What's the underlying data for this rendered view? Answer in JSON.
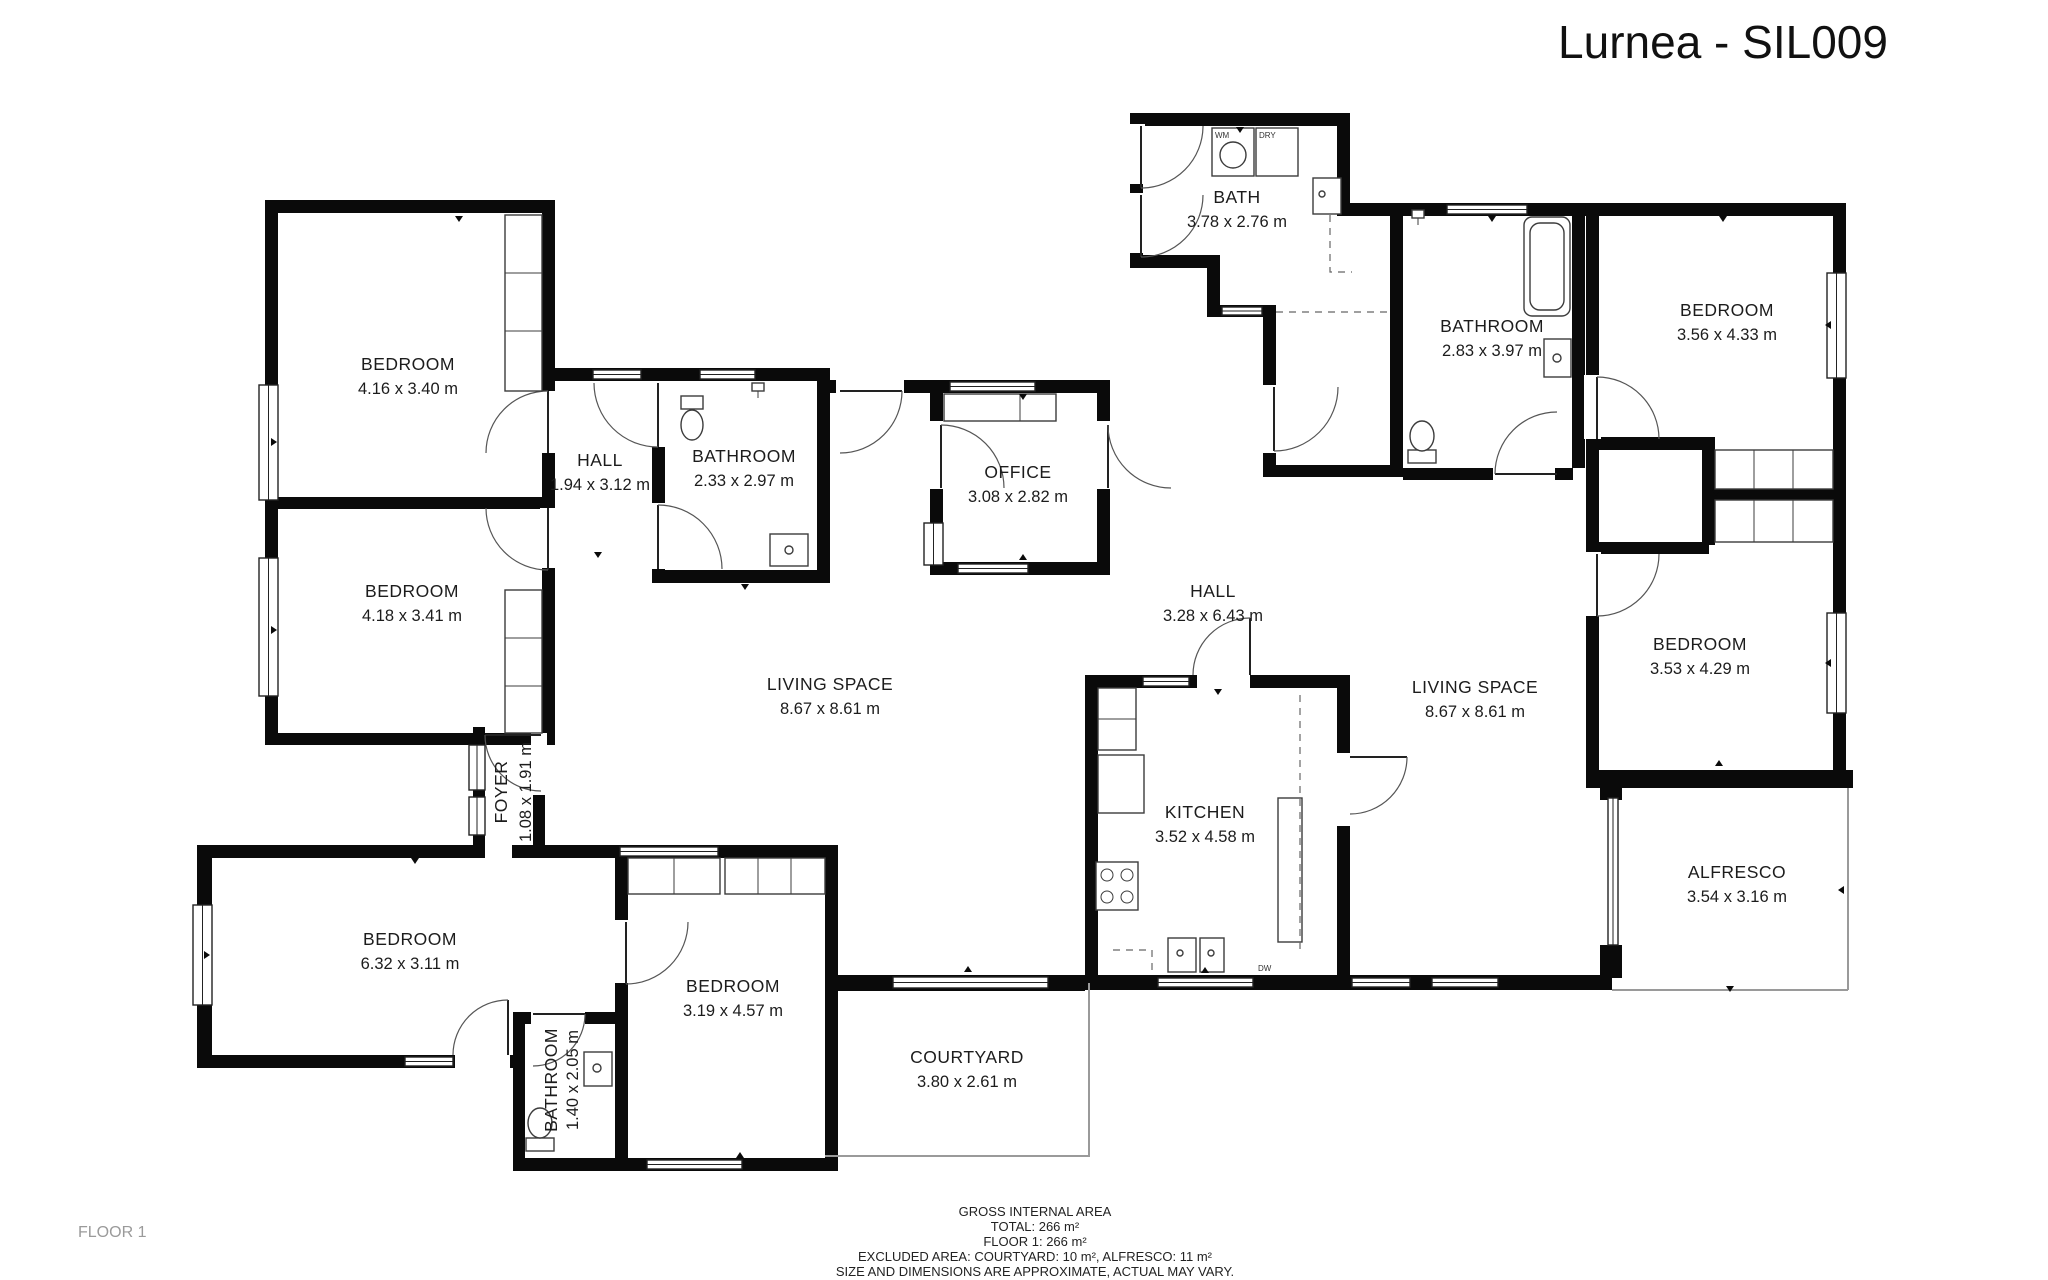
{
  "title": "Lurnea - SIL009",
  "floor_label": "FLOOR 1",
  "rooms": [
    {
      "id": "bedroom-nw-1",
      "name": "BEDROOM",
      "dims": "4.16 x 3.40 m"
    },
    {
      "id": "bedroom-nw-2",
      "name": "BEDROOM",
      "dims": "4.18 x 3.41 m"
    },
    {
      "id": "hall-west",
      "name": "HALL",
      "dims": "1.94 x 3.12 m"
    },
    {
      "id": "bathroom-west",
      "name": "BATHROOM",
      "dims": "2.33 x 2.97 m"
    },
    {
      "id": "office",
      "name": "OFFICE",
      "dims": "3.08 x 2.82 m"
    },
    {
      "id": "bath",
      "name": "BATH",
      "dims": "3.78 x 2.76 m"
    },
    {
      "id": "bathroom-ne",
      "name": "BATHROOM",
      "dims": "2.83 x 3.97 m"
    },
    {
      "id": "bedroom-ne",
      "name": "BEDROOM",
      "dims": "3.56 x 4.33 m"
    },
    {
      "id": "hall-main",
      "name": "HALL",
      "dims": "3.28 x 6.43 m"
    },
    {
      "id": "living-west",
      "name": "LIVING SPACE",
      "dims": "8.67 x 8.61 m"
    },
    {
      "id": "living-east",
      "name": "LIVING SPACE",
      "dims": "8.67 x 8.61 m"
    },
    {
      "id": "bedroom-east",
      "name": "BEDROOM",
      "dims": "3.53 x 4.29 m"
    },
    {
      "id": "kitchen",
      "name": "KITCHEN",
      "dims": "3.52 x 4.58 m"
    },
    {
      "id": "foyer",
      "name": "FOYER",
      "dims": "1.08 x 1.91 m"
    },
    {
      "id": "bedroom-sw",
      "name": "BEDROOM",
      "dims": "6.32 x 3.11 m"
    },
    {
      "id": "bedroom-south",
      "name": "BEDROOM",
      "dims": "3.19 x 4.57 m"
    },
    {
      "id": "bathroom-south",
      "name": "BATHROOM",
      "dims": "1.40 x 2.05 m"
    },
    {
      "id": "courtyard",
      "name": "COURTYARD",
      "dims": "3.80 x 2.61 m"
    },
    {
      "id": "alfresco",
      "name": "ALFRESCO",
      "dims": "3.54 x 3.16 m"
    }
  ],
  "appliances": {
    "washer": "WM",
    "dryer": "DRY",
    "dishwasher": "DW"
  },
  "footer": {
    "line1": "GROSS INTERNAL AREA",
    "line2": "TOTAL: 266 m²",
    "line3": "FLOOR 1: 266 m²",
    "line4": "EXCLUDED AREA: COURTYARD: 10 m², ALFRESCO: 11 m²",
    "line5": "SIZE AND DIMENSIONS ARE APPROXIMATE, ACTUAL MAY VARY."
  },
  "colors": {
    "wall": "#0a0a0a",
    "boundary": "#9a9a9a",
    "text": "#1c1c1c",
    "muted": "#9a9a9a"
  }
}
